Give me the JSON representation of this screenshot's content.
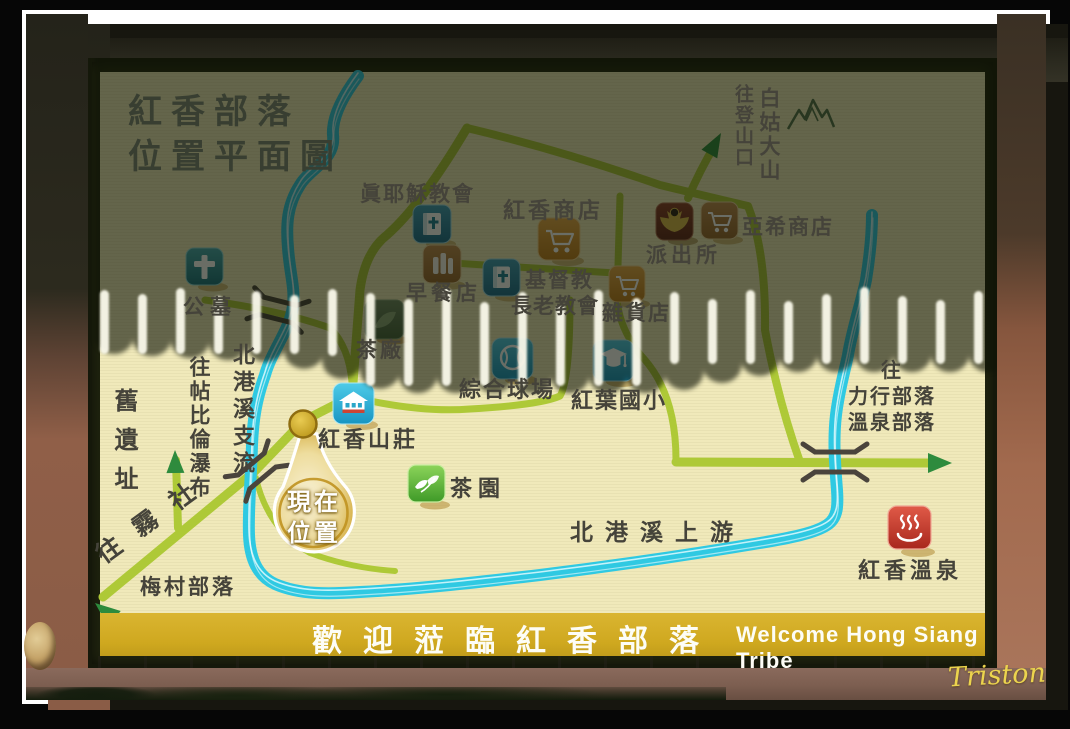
{
  "photo": {
    "watermark": "Triston"
  },
  "sign": {
    "title": {
      "line1": "紅香部落",
      "line2": "位置平面圖"
    },
    "banner": {
      "zh": "歡迎蒞臨紅香部落",
      "en": "Welcome Hong Siang Tribe"
    },
    "labels": {
      "true_jesus_church": "眞耶穌教會",
      "hongsiang_store": "紅香商店",
      "yaxi_store": "亞希商店",
      "police_station": "派出所",
      "breakfast_shop": "早餐店",
      "presbyterian_line1": "基督教",
      "presbyterian_line2": "長老教會",
      "grocery_store": "雜貨店",
      "cemetery": "公墓",
      "tea_factory": "茶廠",
      "sports_court": "綜合球場",
      "hongye_elementary": "紅葉國小",
      "hongsiang_villa": "紅香山莊",
      "tea_garden": "茶園",
      "river_upstream": "北港溪上游",
      "river_tributary": "北港溪支流",
      "hongsiang_hotspring": "紅香溫泉",
      "to_trailhead": "往登山口",
      "baigu_mountain": "白姑大山",
      "old_ruins": "舊遺址",
      "to_tiebilun_waterfall": "往帖比倫瀑布",
      "to_wushe": "往霧社",
      "meicun_tribe": "梅村部落",
      "to_lixing_line1": "往",
      "to_lixing_line2": "力行部落",
      "to_lixing_line3": "溫泉部落",
      "current_location_line1": "現在",
      "current_location_line2": "位置"
    },
    "icons": {
      "cemetery": "cross-icon",
      "true_jesus_church": "bible-icon",
      "presbyterian_church": "bible-icon",
      "hongsiang_store": "shopping-cart-icon",
      "yaxi_store": "shopping-cart-icon",
      "grocery_store": "shopping-cart-icon",
      "breakfast_shop": "bottles-icon",
      "police_station": "police-badge-icon",
      "tea_factory": "leaf-icon",
      "sports_court": "baseball-icon",
      "hongye_elementary": "graduation-cap-icon",
      "hongsiang_villa": "pagoda-icon",
      "tea_garden": "sprout-icon",
      "hongsiang_hotspring": "hotspring-icon",
      "baigu_mountain": "mountain-peaks-icon",
      "current_location": "location-balloon-marker"
    },
    "colors": {
      "road": "#aec937",
      "arrow_green": "#2e8b3d",
      "river": "#2fc9e2",
      "banner_gold": "#cfa81f",
      "paper": "#f0e9ba",
      "marker_gold": "#c9a11b"
    }
  }
}
